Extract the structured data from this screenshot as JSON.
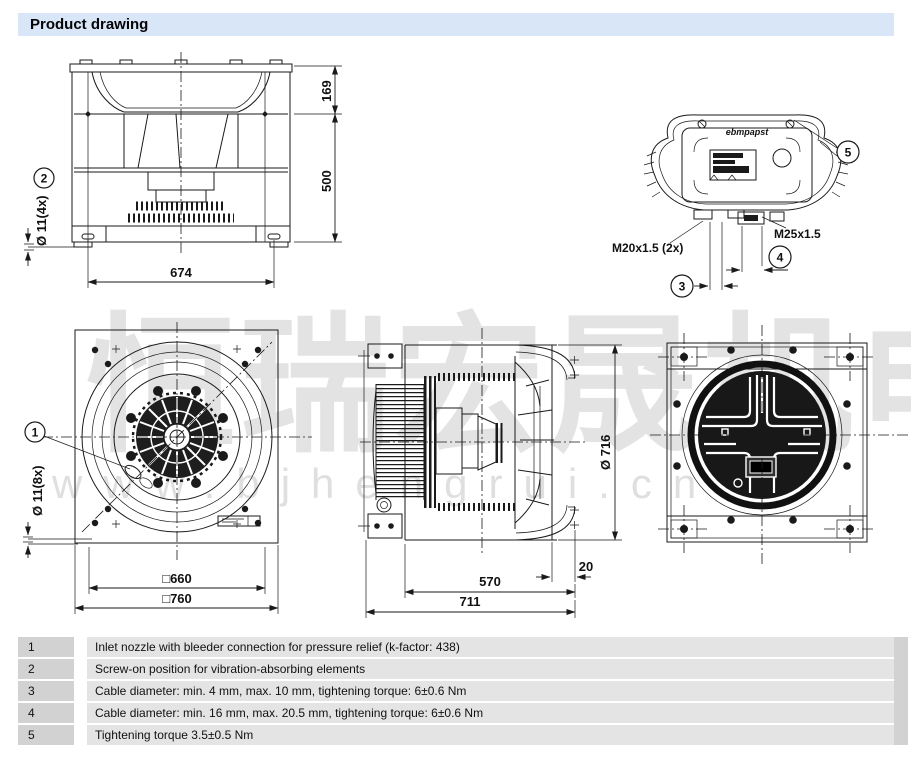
{
  "header": {
    "title": "Product drawing"
  },
  "watermark": {
    "cjk": "恒瑞宏晟机电",
    "url": "www.bjhengrui.cn"
  },
  "colors": {
    "header_bg": "#d9e6f8",
    "legend_num_bg": "#d2d2d2",
    "legend_row_bg": "#e4e4e4",
    "line": "#1a1a1a",
    "watermark": "#c9c9c9"
  },
  "views": {
    "side_view": {
      "dim_top": "169",
      "dim_main": "500",
      "dim_width": "674",
      "hole_label": "Ø 11(4x)",
      "callout": "2"
    },
    "terminal_box": {
      "logo": "ebmpapst",
      "gland_small": "M20x1.5 (2x)",
      "gland_large": "M25x1.5",
      "callout_3": "3",
      "callout_4": "4",
      "callout_5": "5"
    },
    "front_view": {
      "dim_inner": "□660",
      "dim_outer": "□760",
      "hole_label": "Ø 11(8x)",
      "callout": "1"
    },
    "depth_view": {
      "dim_diameter": "Ø 716",
      "dim_ring": "20",
      "dim_housing": "570",
      "dim_total": "711"
    }
  },
  "legend": {
    "rows": [
      {
        "num": "1",
        "text": "Inlet nozzle with bleeder connection for pressure relief (k-factor: 438)"
      },
      {
        "num": "2",
        "text": "Screw-on position for vibration-absorbing elements"
      },
      {
        "num": "3",
        "text": "Cable diameter: min. 4 mm, max. 10 mm, tightening torque: 6±0.6 Nm"
      },
      {
        "num": "4",
        "text": "Cable diameter: min. 16 mm, max. 20.5 mm, tightening torque: 6±0.6 Nm"
      },
      {
        "num": "5",
        "text": "Tightening torque 3.5±0.5 Nm"
      }
    ]
  }
}
